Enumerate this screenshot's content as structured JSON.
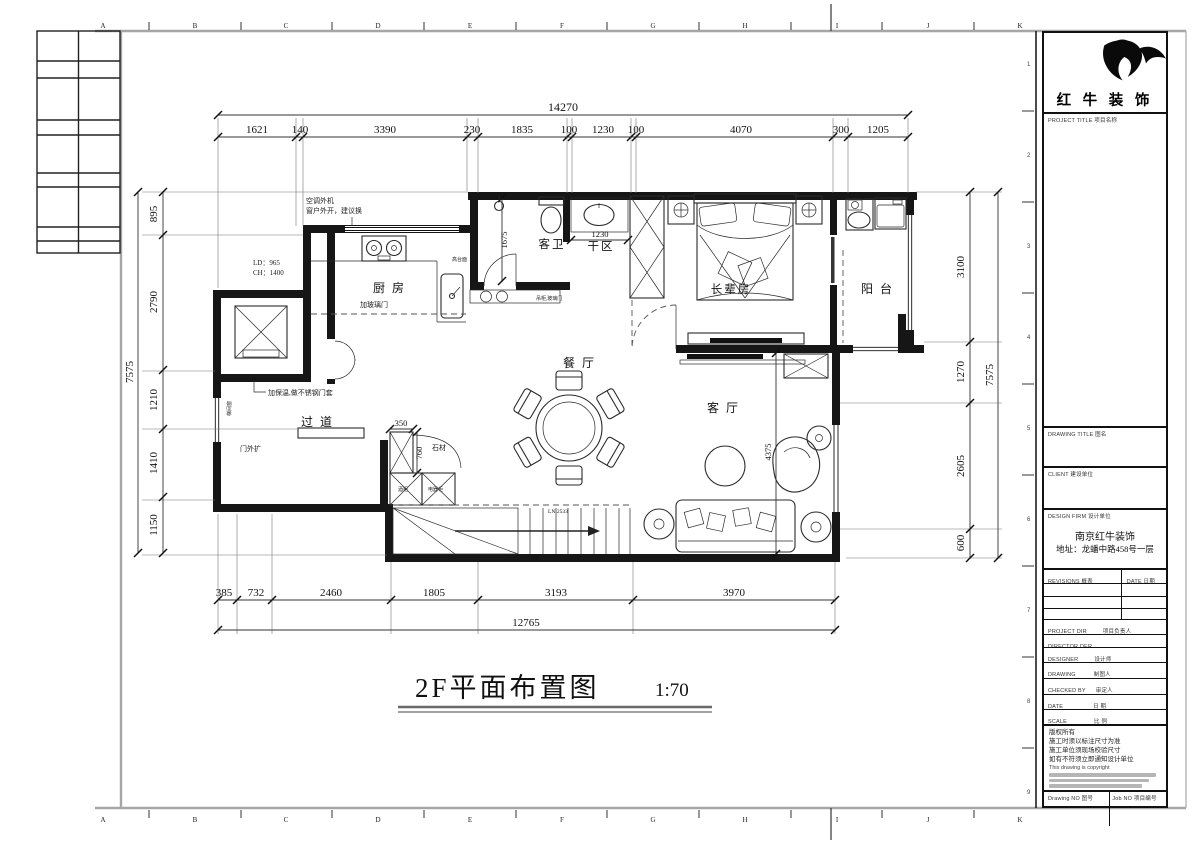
{
  "sheet": {
    "title": "2F平面布置图",
    "scale": "1:70"
  },
  "grid": {
    "letters": [
      "A",
      "B",
      "C",
      "D",
      "E",
      "F",
      "G",
      "H",
      "I",
      "J",
      "K"
    ],
    "numbers": [
      "1",
      "2",
      "3",
      "4",
      "5",
      "6",
      "7",
      "8",
      "9"
    ]
  },
  "rooms": {
    "kitchen": "厨房",
    "guest_bath": "客卫",
    "dry_area": "干区",
    "elder_room": "长辈房",
    "balcony": "阳台",
    "dining": "餐厅",
    "living": "客厅",
    "corridor": "过道"
  },
  "dims": {
    "top": {
      "total": "14270",
      "segments": [
        "1621",
        "140",
        "3390",
        "230",
        "1835",
        "100",
        "1230",
        "100",
        "4070",
        "300",
        "1205"
      ]
    },
    "bottom": {
      "total": "12765",
      "segments": [
        "385",
        "732",
        "2460",
        "1805",
        "3193",
        "3970"
      ]
    },
    "left": {
      "total": "7575",
      "segments": [
        "895",
        "2790",
        "1210",
        "1410",
        "1150"
      ]
    },
    "right": {
      "total": "7575",
      "segments": [
        "3100",
        "1270",
        "2605",
        "600"
      ]
    },
    "inner": {
      "bath": "1675",
      "basin": "1230",
      "cab_w": "350",
      "cab_d": "760",
      "living": "4375",
      "stair": "LN:2533"
    }
  },
  "notes": {
    "ac1": "空调外机",
    "ac2": "窗户外开，建议换",
    "lift1": "LD：965",
    "lift2": "CH：1400",
    "insul": "加保温,做不锈钢门套",
    "door_out": "门外扩",
    "stair_win": "梯间窗",
    "stone": "石材",
    "glass": "加玻璃门",
    "high": "高台面",
    "hang": "吊柜,玻璃门",
    "wine": "酒柜",
    "appl": "电器柜"
  },
  "titleblock": {
    "company": "红 牛 装 饰",
    "sec_project": "PROJECT TITLE  项目名称",
    "sec_drawing_title": "DRAWING TITLE  图名",
    "sec_client": "CLIENT  建设单位",
    "sec_firm": "DESIGN FIRM  设计单位",
    "firm_name": "南京红牛装饰",
    "firm_addr": "地址：龙蟠中路458号一层",
    "rev": "REVISIONS  概表",
    "rev_date": "DATE  日期",
    "rows": [
      {
        "en": "PROJECT DIR",
        "cn": "项目负责人"
      },
      {
        "en": "DIRECTOR DER",
        "cn": ""
      },
      {
        "en": "DESIGNER",
        "cn": "设计师"
      },
      {
        "en": "DRAWING",
        "cn": "制图人"
      },
      {
        "en": "CHECKED BY",
        "cn": "审定人"
      },
      {
        "en": "DATE",
        "cn": "日  期"
      },
      {
        "en": "SCALE",
        "cn": "比  例"
      }
    ],
    "copy": [
      "版权所有",
      "施工时须以标注尺寸为准",
      "施工单位须现场校验尺寸",
      "如有不符须立即通知设计单位",
      "This drawing is copyright"
    ],
    "no1": "Drawing NO  图号",
    "no2": "Job NO  项目编号"
  }
}
